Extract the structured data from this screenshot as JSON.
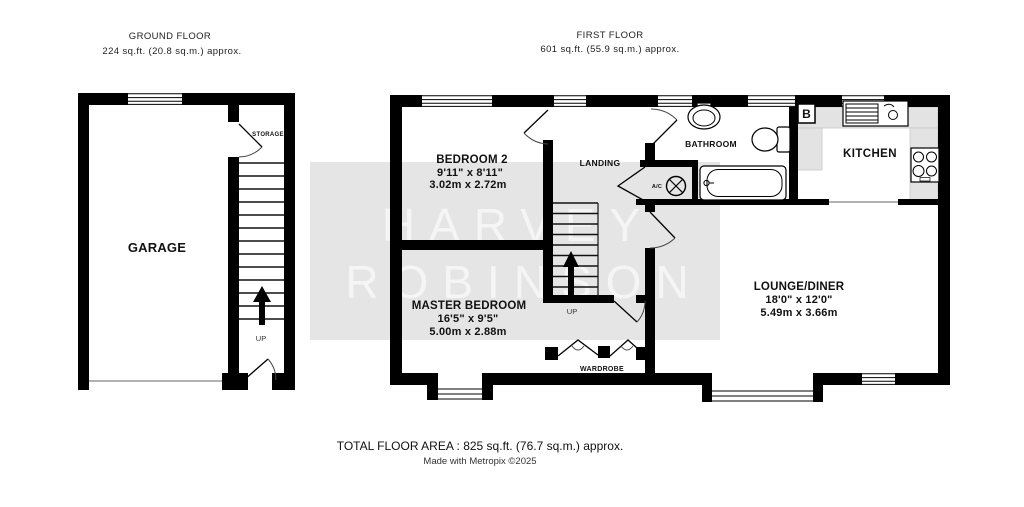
{
  "header": {
    "ground_floor": {
      "title": "GROUND FLOOR",
      "area": "224 sq.ft. (20.8 sq.m.) approx."
    },
    "first_floor": {
      "title": "FIRST FLOOR",
      "area": "601 sq.ft. (55.9 sq.m.) approx."
    }
  },
  "rooms": {
    "garage": {
      "label": "GARAGE"
    },
    "storage": {
      "label": "STORAGE"
    },
    "bedroom2": {
      "label": "BEDROOM 2",
      "dims_imperial": "9'11\" x 8'11\"",
      "dims_metric": "3.02m x 2.72m"
    },
    "master_bedroom": {
      "label": "MASTER BEDROOM",
      "dims_imperial": "16'5\" x 9'5\"",
      "dims_metric": "5.00m x 2.88m"
    },
    "lounge_diner": {
      "label": "LOUNGE/DINER",
      "dims_imperial": "18'0\" x 12'0\"",
      "dims_metric": "5.49m x 3.66m"
    },
    "landing": {
      "label": "LANDING"
    },
    "bathroom": {
      "label": "BATHROOM"
    },
    "kitchen": {
      "label": "KITCHEN"
    },
    "wardrobe": {
      "label": "WARDROBE"
    }
  },
  "labels": {
    "up_ground": "UP",
    "up_first": "UP",
    "airing_cupboard": "A/C",
    "boiler": "B"
  },
  "watermark": {
    "line1": "HARVEY",
    "line2": "ROBINSON"
  },
  "footer": {
    "total": "TOTAL FLOOR AREA : 825 sq.ft. (76.7 sq.m.) approx.",
    "credit": "Made with Metropix ©2025"
  },
  "colors": {
    "wall": "#000000",
    "counter": "#e3e3e3",
    "watermark_band": "#e5e5e5",
    "watermark_text": "#f5f5f5"
  }
}
